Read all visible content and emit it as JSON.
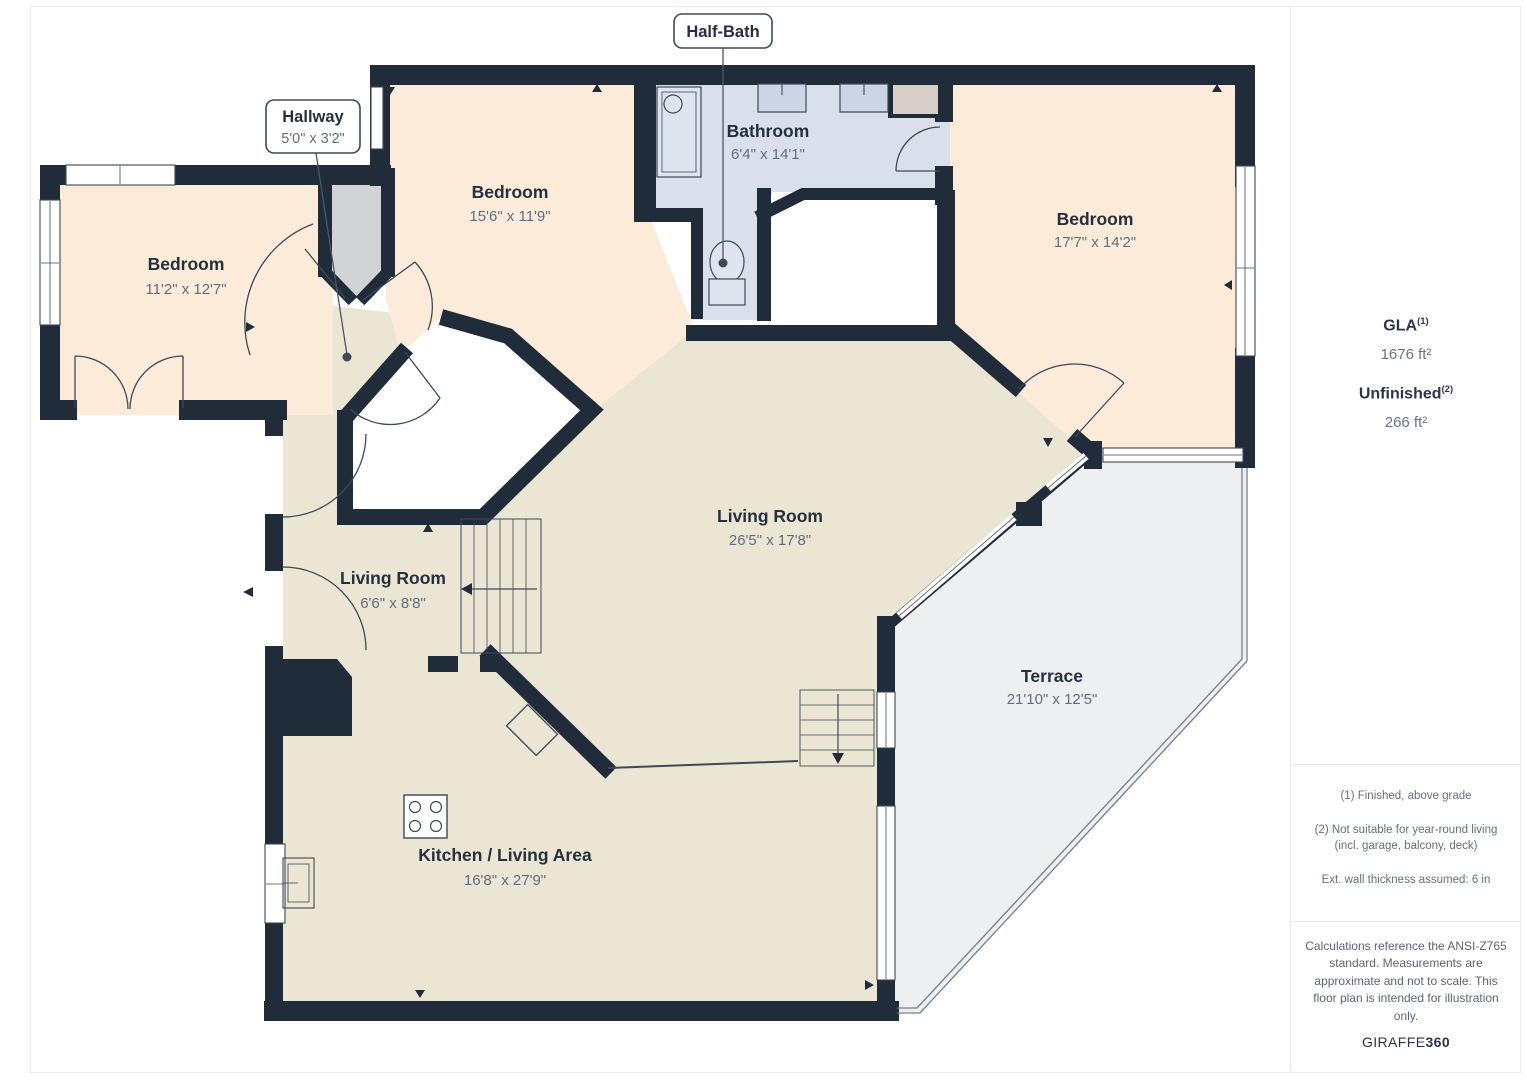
{
  "plan": {
    "callouts": {
      "half_bath": {
        "label": "Half-Bath"
      },
      "hallway": {
        "label": "Hallway",
        "dims": "5'0\" x 3'2\""
      }
    },
    "rooms": {
      "bedroom_left": {
        "label": "Bedroom",
        "dims": "11'2\" x 12'7\""
      },
      "bedroom_top": {
        "label": "Bedroom",
        "dims": "15'6\" x 11'9\""
      },
      "bathroom": {
        "label": "Bathroom",
        "dims": "6'4\" x 14'1\""
      },
      "bedroom_right": {
        "label": "Bedroom",
        "dims": "17'7\" x 14'2\""
      },
      "living_room_main": {
        "label": "Living Room",
        "dims": "26'5\" x 17'8\""
      },
      "living_room_small": {
        "label": "Living Room",
        "dims": "6'6\" x 8'8\""
      },
      "terrace": {
        "label": "Terrace",
        "dims": "21'10\" x 12'5\""
      },
      "kitchen": {
        "label": "Kitchen / Living Area",
        "dims": "16'8\" x 27'9\""
      }
    },
    "colors": {
      "wall": "#212c3b",
      "bedroom_fill": "#fcebd9",
      "bathroom_fill": "#d9e0ec",
      "living_fill": "#ebe5d3",
      "terrace_fill": "#edeff1",
      "hallway_fill": "#d2d3d5",
      "closet_fill": "#d5cfc8"
    }
  },
  "sidebar": {
    "gla_label": "GLA",
    "gla_note": "(1)",
    "gla_value": "1676 ft²",
    "unfinished_label": "Unfinished",
    "unfinished_note": "(2)",
    "unfinished_value": "266 ft²",
    "footnotes": [
      "(1) Finished, above grade",
      "(2) Not suitable for year-round living (incl. garage, balcony, deck)",
      "Ext. wall thickness assumed: 6 in"
    ],
    "disclaimer": "Calculations reference the ANSI-Z765 standard. Measurements are approximate and not to scale. This floor plan is intended for illustration only.",
    "logo_primary": "GIRAFFE",
    "logo_secondary": "360"
  }
}
